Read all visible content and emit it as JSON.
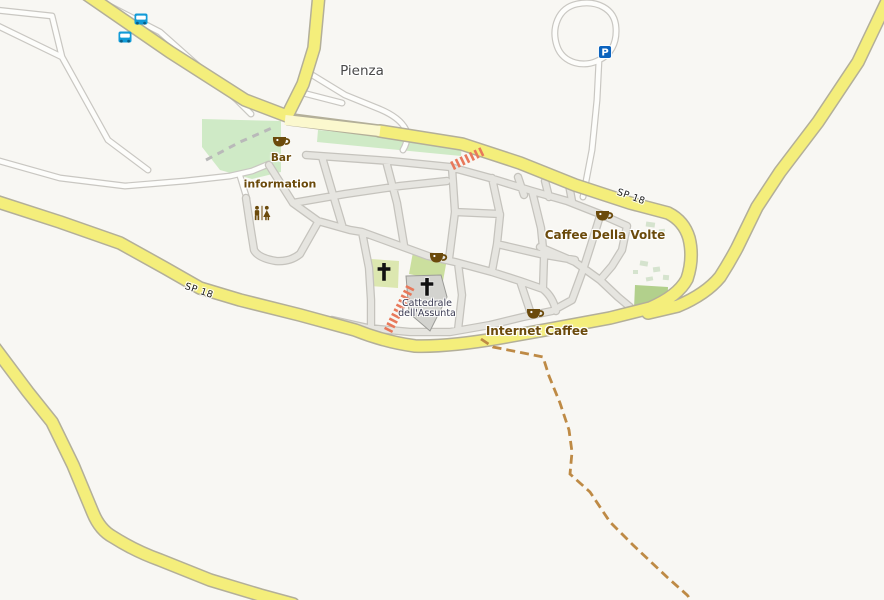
{
  "map": {
    "place_label": "Pienza",
    "labels": {
      "pienza": "Pienza",
      "bar": "Bar",
      "information": "information",
      "caffee_della_volte": "Caffee Della Volte",
      "internet_caffee": "Internet Caffee",
      "cattedrale_line1": "Cattedrale",
      "cattedrale_line2": "dell'Assunta",
      "sp18_west": "SP 18",
      "sp18_east": "SP 18",
      "parking_letter": "P"
    },
    "pois": [
      {
        "id": "bar",
        "label": "Bar",
        "type": "cafe"
      },
      {
        "id": "information",
        "label": "information",
        "type": "tourist-information"
      },
      {
        "id": "toilets",
        "label": "",
        "type": "toilets"
      },
      {
        "id": "caffee-della-volte",
        "label": "Caffee Della Volte",
        "type": "cafe"
      },
      {
        "id": "internet-caffee",
        "label": "Internet Caffee",
        "type": "cafe"
      },
      {
        "id": "cattedrale",
        "label": "Cattedrale dell'Assunta",
        "type": "place-of-worship"
      },
      {
        "id": "church-west",
        "label": "",
        "type": "place-of-worship"
      },
      {
        "id": "parking",
        "label": "P",
        "type": "parking"
      },
      {
        "id": "bus-stop-1",
        "label": "",
        "type": "bus-stop"
      },
      {
        "id": "bus-stop-2",
        "label": "",
        "type": "bus-stop"
      }
    ],
    "road_refs": [
      "SP 18"
    ],
    "colors": {
      "bg": "#F8F7F3",
      "yellow": "#F4EE7B",
      "yellow_casing": "#B3AF99",
      "pale_yellow": "#FBF8CE",
      "white_road": "#FDFDFB",
      "white_road_casing": "#C9C7C2",
      "street": "#E6E5E0",
      "street_casing": "#C5C3BD",
      "park": "#CFEAC6",
      "garden": "#DCE7B0",
      "garden2": "#CBDF9E",
      "village_green": "#B2D08C",
      "scatter_green": "#D5E3CE",
      "building": "#D3D3CF",
      "building_stroke": "#9B9B97",
      "stairs": "#E8785A",
      "trail": "#BE8A45",
      "poi_brown": "#6B4A0B",
      "worship_label": "#3A3A52",
      "place_label": "#4A4A4A",
      "bus_blue": "#129BD7",
      "parking_blue": "#0B63BE"
    }
  }
}
